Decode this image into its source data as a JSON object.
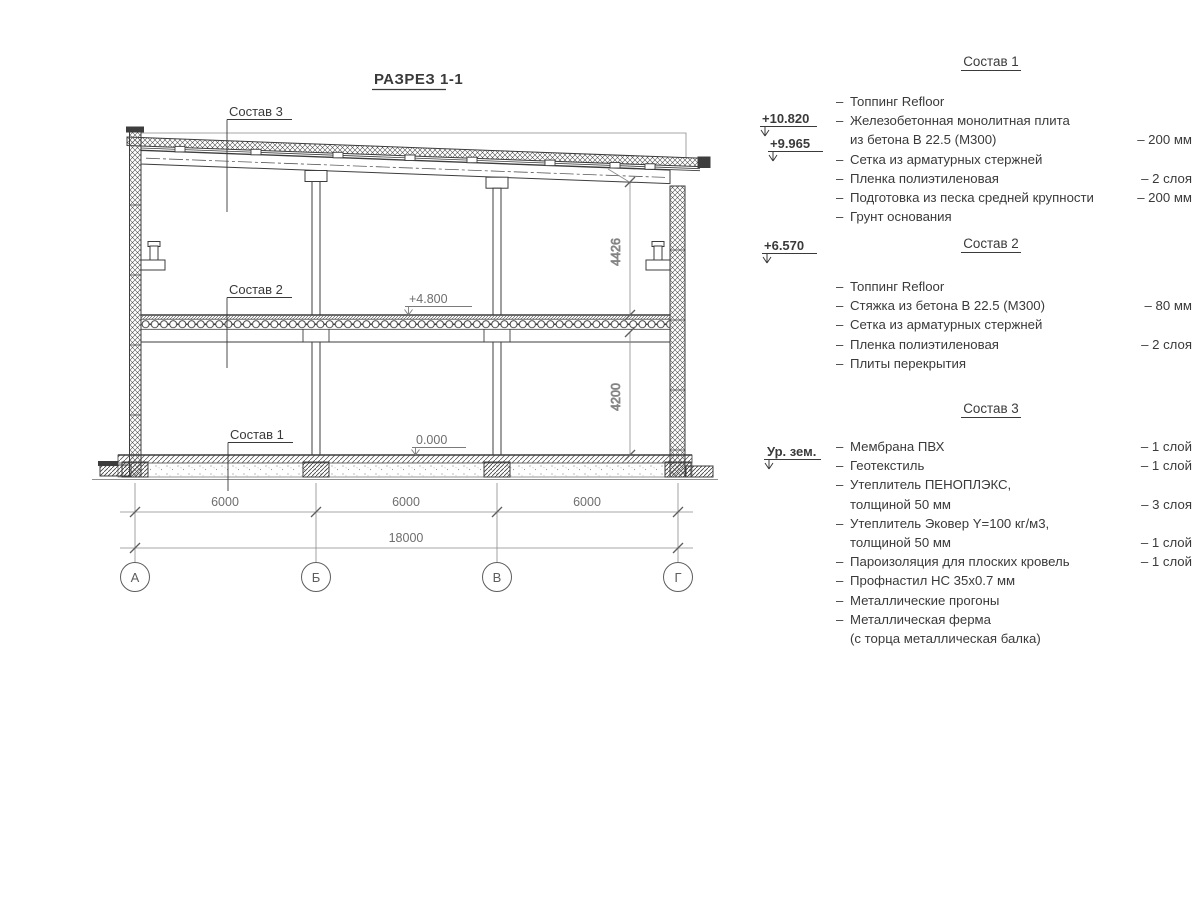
{
  "title": "РАЗРЕЗ 1-1",
  "drawing": {
    "section_labels": {
      "sostav1": "Состав 1",
      "sostav2": "Состав 2",
      "sostav3": "Состав 3"
    },
    "elevations": {
      "plus4800": "+4.800",
      "zero": "0.000"
    },
    "dimensions": {
      "bay1": "6000",
      "bay2": "6000",
      "bay3": "6000",
      "total": "18000",
      "upper": "4426",
      "lower": "4200"
    },
    "axes": [
      "А",
      "Б",
      "В",
      "Г"
    ]
  },
  "elevation_marks": {
    "roof_high": "+10.820",
    "roof_low": "+9.965",
    "crane": "+6.570",
    "ground_level": "Ур. зем."
  },
  "compositions": [
    {
      "heading": "Состав 1",
      "rows": [
        {
          "dash": "–",
          "text": "Топпинг Refloor",
          "qty": ""
        },
        {
          "dash": "–",
          "text": "Железобетонная  монолитная плита",
          "qty": ""
        },
        {
          "dash": "",
          "text": "из бетона В 22.5 (М300)",
          "qty": "– 200 мм"
        },
        {
          "dash": "–",
          "text": "Сетка из арматурных стержней",
          "qty": ""
        },
        {
          "dash": "–",
          "text": "Пленка полиэтиленовая",
          "qty": "–  2 слоя"
        },
        {
          "dash": "–",
          "text": "Подготовка из песка средней крупности",
          "qty": "– 200 мм"
        },
        {
          "dash": "–",
          "text": "Грунт основания",
          "qty": ""
        }
      ]
    },
    {
      "heading": "Состав 2",
      "rows": [
        {
          "dash": "–",
          "text": "Топпинг Refloor",
          "qty": ""
        },
        {
          "dash": "–",
          "text": "Стяжка из бетона В 22.5 (М300)",
          "qty": "– 80 мм"
        },
        {
          "dash": "–",
          "text": "Сетка из арматурных стержней",
          "qty": ""
        },
        {
          "dash": "–",
          "text": "Пленка полиэтиленовая",
          "qty": "–  2 слоя"
        },
        {
          "dash": "–",
          "text": "Плиты перекрытия",
          "qty": ""
        }
      ]
    },
    {
      "heading": "Состав 3",
      "rows": [
        {
          "dash": "–",
          "text": "Мембрана ПВХ",
          "qty": "– 1 слой"
        },
        {
          "dash": "–",
          "text": "Геотекстиль",
          "qty": "– 1 слой"
        },
        {
          "dash": "–",
          "text": "Утеплитель ПЕНОПЛЭКС,",
          "qty": ""
        },
        {
          "dash": "",
          "text": "толщиной 50 мм",
          "qty": "– 3 слоя"
        },
        {
          "dash": "–",
          "text": "Утеплитель Эковер Y=100 кг/м3,",
          "qty": ""
        },
        {
          "dash": "",
          "text": "толщиной 50 мм",
          "qty": "– 1 слой"
        },
        {
          "dash": "–",
          "text": "Пароизоляция для плоских кровель",
          "qty": "– 1 слой"
        },
        {
          "dash": "–",
          "text": "Профнастил НС 35х0.7 мм",
          "qty": ""
        },
        {
          "dash": "–",
          "text": "Металлические прогоны",
          "qty": ""
        },
        {
          "dash": "–",
          "text": "Металлическая ферма",
          "qty": ""
        },
        {
          "dash": "",
          "text": "(с торца металлическая балка)",
          "qty": ""
        }
      ]
    }
  ]
}
